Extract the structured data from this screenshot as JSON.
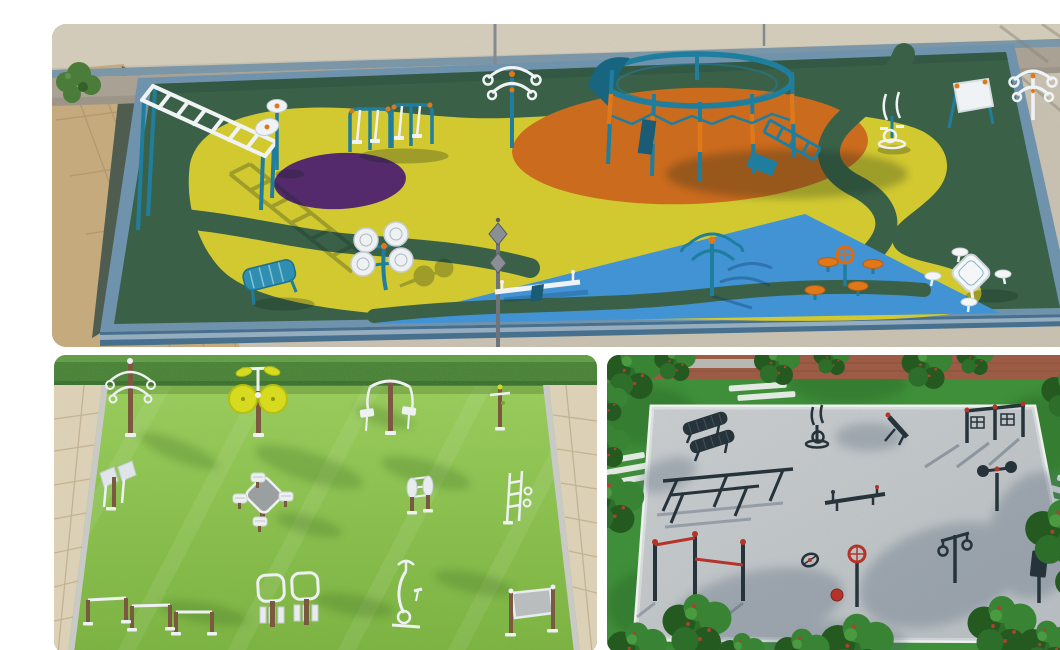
{
  "page": {
    "background": "#ffffff",
    "kind": "3D architectural render collage",
    "subject": "Outdoor fitness playground design concepts, three aerial renders",
    "panel_count": 3
  },
  "panels": [
    {
      "id": "epdm-playground",
      "position": "top",
      "label": "Aerial 3D render of a fitness playground with multicolored EPDM rubber surfacing inside a walled concrete yard",
      "surface_zones": [
        "dark green base",
        "yellow organic island",
        "purple circle",
        "orange oval",
        "blue triangle",
        "dark green winding paths"
      ],
      "environment": [
        "concrete yard",
        "stone perimeter wall with blue-grey rail",
        "brick walkway",
        "green shrub",
        "street lamp poles"
      ],
      "equipment": [
        "inclined monkey-bar ladder",
        "twin spinning discs",
        "double air walker",
        "shoulder wheel station",
        "circular overhead climbing frame with slide",
        "monkey bars",
        "elliptical cross trainer",
        "information board",
        "double shoulder wheels",
        "blue lounge bench",
        "tai chi spinner wheels",
        "twin-lantern lamp post",
        "seesaw",
        "rotating arm spinner",
        "steering wheel",
        "mushroom stools",
        "square table with four stools"
      ]
    },
    {
      "id": "grass-outdoor-gym",
      "position": "bottom-left",
      "label": "Aerial 3D render of a lawn outdoor gym with white and timber fitness stations between beige paved walkways and a clipped hedge",
      "environment": [
        "mown lawn",
        "clipped hedge",
        "beige paved walkways"
      ],
      "equipment": [
        "arm wheel spinner",
        "yellow tai chi discs",
        "lat pull-down station",
        "accessory post",
        "chest press",
        "chess table with four stools",
        "back roller",
        "weight ladder station",
        "triple push-up bars",
        "double leg press",
        "exercise bike",
        "information board"
      ]
    },
    {
      "id": "gravel-street-workout",
      "position": "bottom-right",
      "label": "Aerial 3D render of a grey gravel street-workout court framed by trees, white crosswalk stripes and a red clay path",
      "environment": [
        "grey gravel pad with white edging",
        "lawn",
        "leafy trees with red berries",
        "red clay path",
        "white crosswalk markings"
      ],
      "equipment": [
        "two curved benches",
        "elliptical trainer",
        "incline sit-up board",
        "double lat pull-down",
        "slanted parallel rails",
        "balance beam with handles",
        "twin-disc spinner",
        "staggered pull-up bars with red bars",
        "ground spinner wheel",
        "red steering wheel post",
        "hanging rings station",
        "exercise board post"
      ]
    }
  ],
  "colors": {
    "page_bg": "#ffffff",
    "tp_concrete": "#c9c1b1",
    "tp_concrete_light": "#d6cebc",
    "tp_wall": "#a9a294",
    "tp_rail": "#7b96a7",
    "tp_brick": "#c5aa7e",
    "tp_slope": "#4f5c50",
    "tp_curb": "#6f93ac",
    "tp_curb_face": "#47708e",
    "tp_field": "#3a6147",
    "tp_field_deep": "#2d5240",
    "tp_yellow": "#d2c931",
    "tp_purple": "#542a6d",
    "tp_orange": "#cb6b1d",
    "tp_blue": "#4293d4",
    "tp_teal": "#1f7e9e",
    "tp_teal_dark": "#17657f",
    "tp_white": "#f0f3f5",
    "tp_accent": "#e07818",
    "tp_lamp": "#84888f",
    "bl_grass_light": "#9ccf5d",
    "bl_grass": "#7ab23f",
    "bl_hedge": "#477f36",
    "bl_hedge_light": "#66a24c",
    "bl_paving": "#dcd0b6",
    "bl_paving_line": "#bfae8e",
    "bl_curb": "#c9c9c6",
    "bl_wood": "#7b5940",
    "bl_metal": "#eef1f2",
    "bl_metal_dim": "#c6cdd2",
    "bl_disc_yellow": "#d6db1f",
    "bl_table_gray": "#9aa0a0",
    "br_lawn": "#3f8f3a",
    "br_lawn_dark": "#2e6f2a",
    "br_brick": "#9c5b45",
    "br_pad": "#c3c7c9",
    "br_white": "#eef0ef",
    "br_dark": "#26333a",
    "br_red": "#b5342a",
    "br_tree_dark": "#24591f",
    "br_tree_mid": "#2d6e2b",
    "br_tree_light": "#398334",
    "br_trunk": "#6b4a33"
  }
}
